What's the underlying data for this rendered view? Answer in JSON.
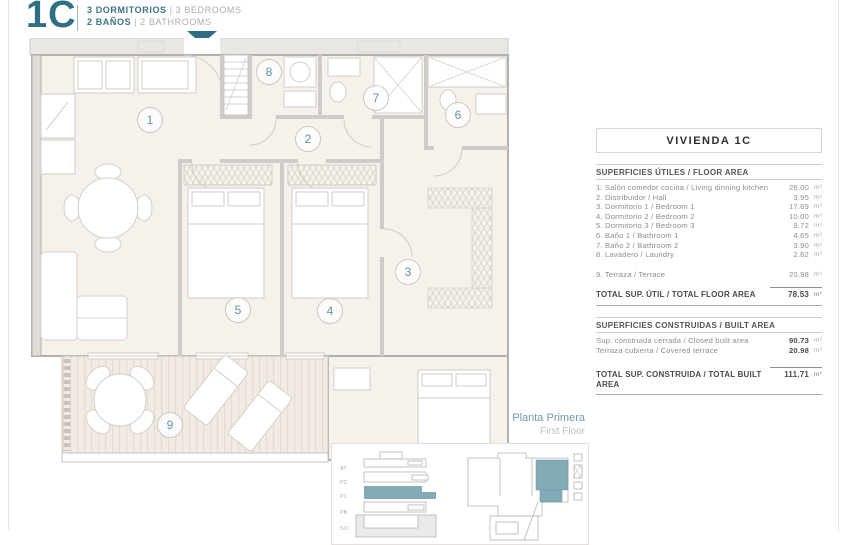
{
  "header": {
    "code": "1C",
    "separator": "|",
    "bedrooms_es": "3 DORMITORIOS",
    "bedrooms_en": "3 BEDROOMS",
    "bathrooms_es": "2 BAÑOS",
    "bathrooms_en": "2 BATHROOMS"
  },
  "plan": {
    "room_numbers": [
      "1",
      "2",
      "3",
      "4",
      "5",
      "6",
      "7",
      "8",
      "9"
    ],
    "floor_label": {
      "es": "Planta Primera",
      "en": "First Floor"
    },
    "mini_floors": [
      "AT",
      "P2",
      "P1",
      "PB",
      "SO"
    ],
    "accent_color": "#2f6e84",
    "highlight_color": "#82aab7"
  },
  "panel": {
    "title": "VIVIENDA 1C",
    "unit": "m²",
    "floor_area": {
      "heading": "SUPERFICIES ÚTILES / FLOOR AREA",
      "rows": [
        {
          "label": "1. Salón comedor cocina / Living dinning kitchen",
          "value": "26.00"
        },
        {
          "label": "2. Distribuidor / Hall",
          "value": "3.95"
        },
        {
          "label": "3. Dormitorio 1 / Bedroom 1",
          "value": "17.69"
        },
        {
          "label": "4. Dormitorio 2 / Bedroom 2",
          "value": "10.00"
        },
        {
          "label": "5. Dormitorio 3 / Bedroom 3",
          "value": "9.72"
        },
        {
          "label": "6. Baño 1 / Bathroom 1",
          "value": "4.65"
        },
        {
          "label": "7. Baño 2 / Bathroom 2",
          "value": "3.90"
        },
        {
          "label": "8. Lavadero / Laundry",
          "value": "2.62"
        }
      ],
      "terrace_row": {
        "label": "9. Terraza / Terrace",
        "value": "20.98"
      },
      "total": {
        "label": "TOTAL SUP. ÚTIL / TOTAL FLOOR AREA",
        "value": "78.53"
      }
    },
    "built_area": {
      "heading": "SUPERFICIES CONSTRUIDAS / BUILT AREA",
      "rows": [
        {
          "label": "Sup. construida cerrada / Closed built area",
          "value": "90.73"
        },
        {
          "label": "Terraza cubierta / Covered terrace",
          "value": "20.98"
        }
      ],
      "total": {
        "label": "TOTAL SUP. CONSTRUIDA / TOTAL BUILT AREA",
        "value": "111.71"
      }
    }
  }
}
